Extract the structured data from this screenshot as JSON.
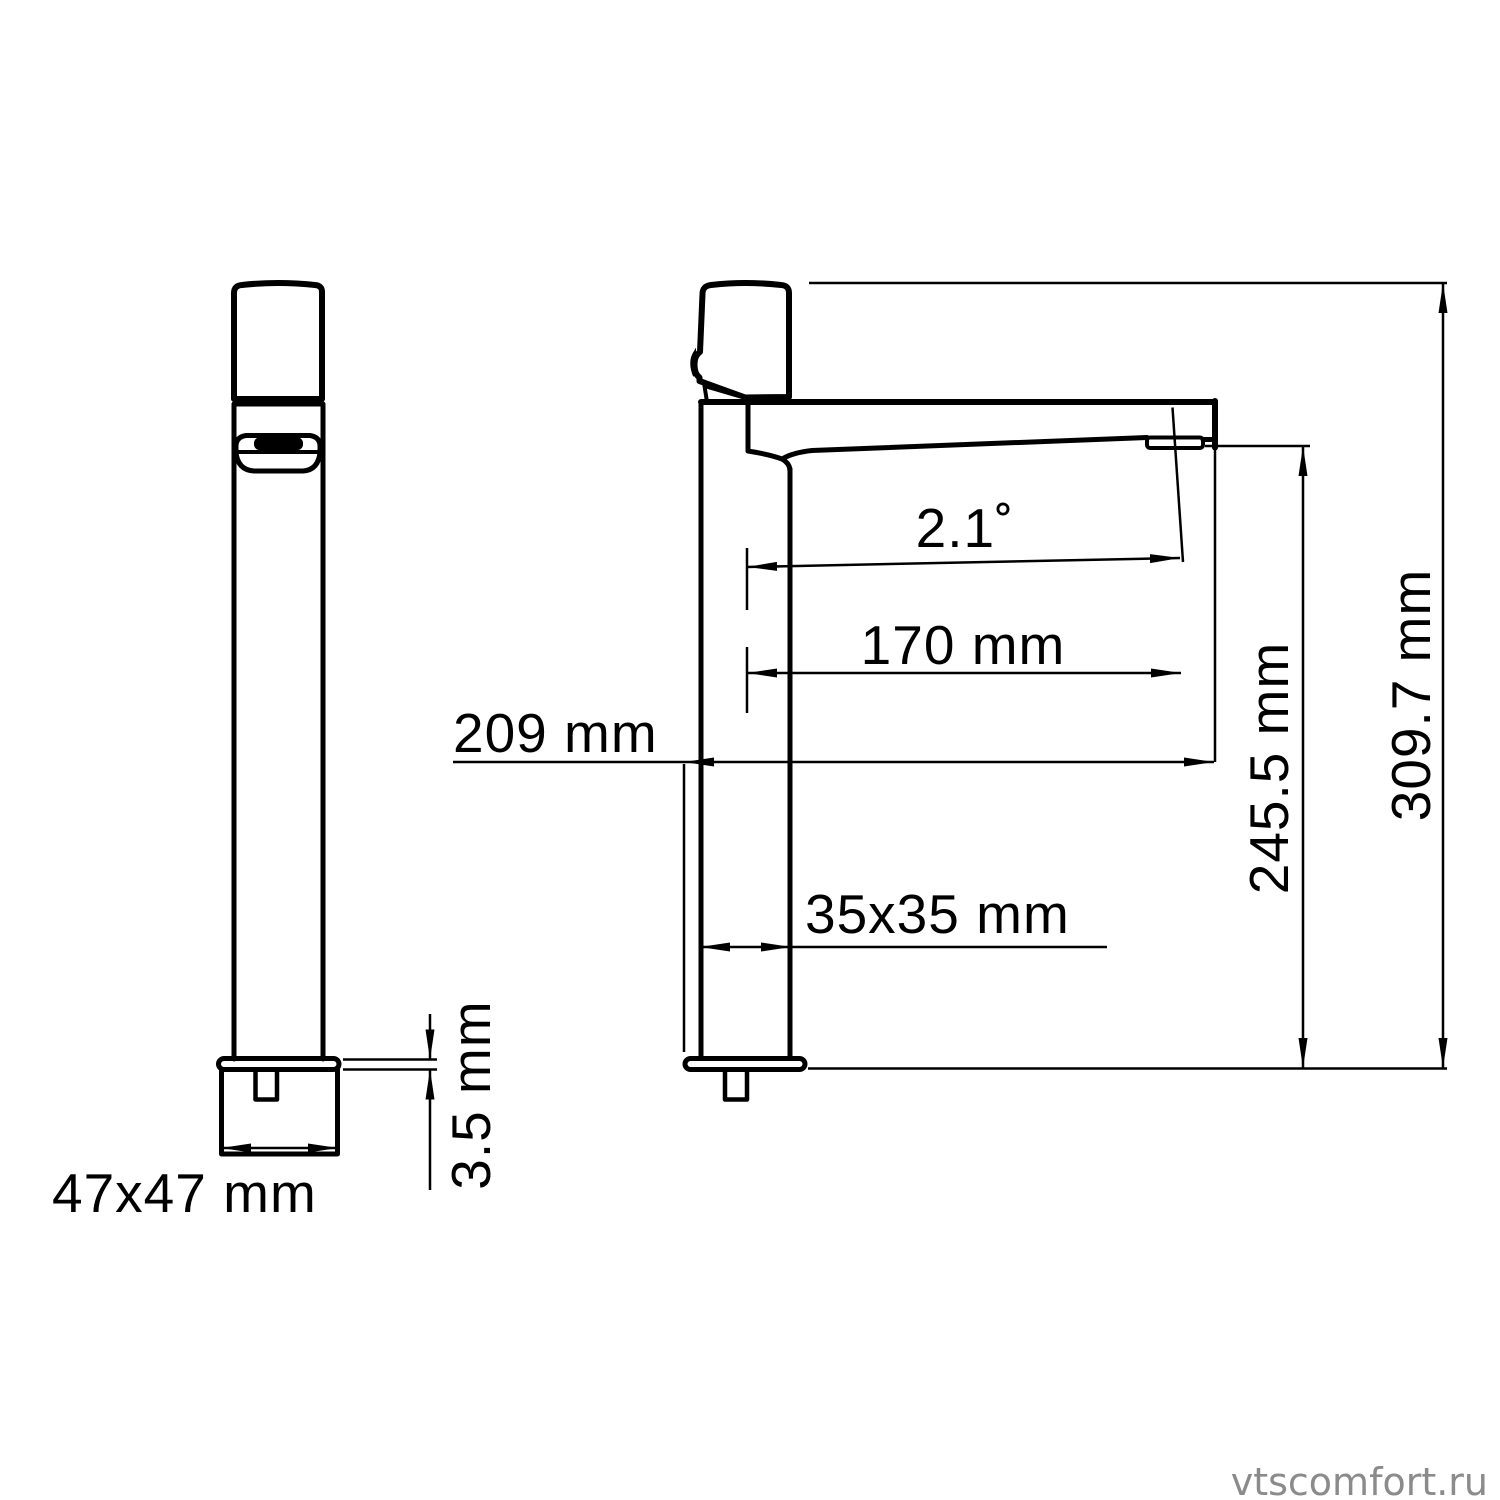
{
  "drawing": {
    "title": "basin mixer faucet dimensional drawing",
    "colors": {
      "ink": "#000000",
      "background": "#ffffff",
      "watermark": "#8b8b8b"
    }
  },
  "dimensions": {
    "base": {
      "label": "47x47 mm"
    },
    "plate": {
      "label": "3.5 mm"
    },
    "body": {
      "label": "35x35 mm"
    },
    "reach": {
      "label": "209 mm"
    },
    "spout_reach": {
      "label": "170 mm"
    },
    "angle": {
      "label": "2.1˚"
    },
    "spout_height": {
      "label": "245.5 mm"
    },
    "total_height": {
      "label": "309.7 mm"
    }
  },
  "watermark": {
    "text": "vtscomfort.ru"
  }
}
